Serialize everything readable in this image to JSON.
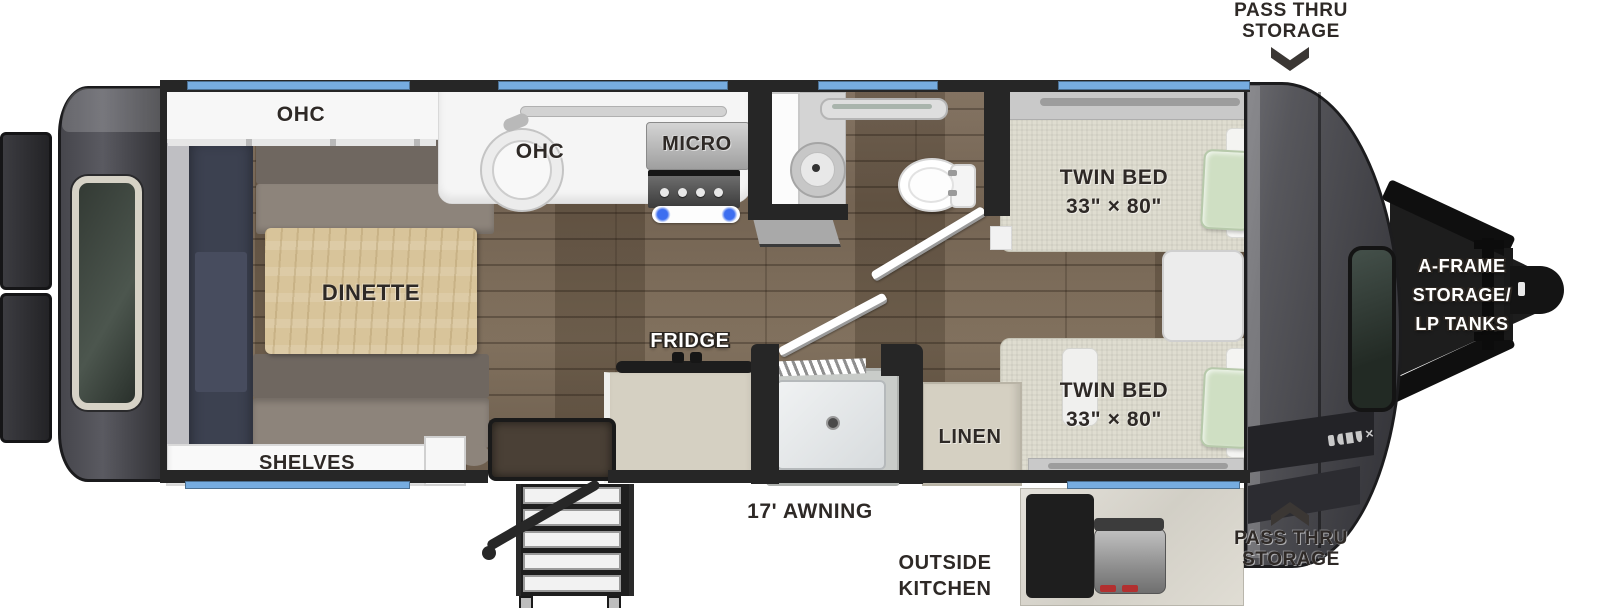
{
  "labels": {
    "pass_thru_top": {
      "line1": "PASS THRU",
      "line2": "STORAGE"
    },
    "pass_thru_bottom": {
      "line1": "PASS THRU",
      "line2": "STORAGE"
    },
    "aframe": {
      "line1": "A-FRAME",
      "line2": "STORAGE/",
      "line3": "LP TANKS"
    },
    "ohc_rear": "OHC",
    "ohc_kitchen": "OHC",
    "micro": "MICRO",
    "dinette": "DINETTE",
    "fridge": "FRIDGE",
    "linen": "LINEN",
    "shelves": "SHELVES",
    "awning": "17' AWNING",
    "outside_kitchen": {
      "line1": "OUTSIDE",
      "line2": "KITCHEN"
    },
    "twin_bed_top": {
      "line1": "TWIN BED",
      "line2": "33\" × 80\""
    },
    "twin_bed_bottom": {
      "line1": "TWIN BED",
      "line2": "33\" × 80\""
    }
  },
  "colors": {
    "window_blue": "#76ace0",
    "wall_dark": "#262626",
    "cabinet_beige": "#d5d0c2",
    "label_dark": "#2e2926",
    "bench_taupe": "#8d847b",
    "bed_linen": "#dfddd0",
    "pillow_green": "#cfdfc3",
    "table_pine": "#d8c49a"
  }
}
